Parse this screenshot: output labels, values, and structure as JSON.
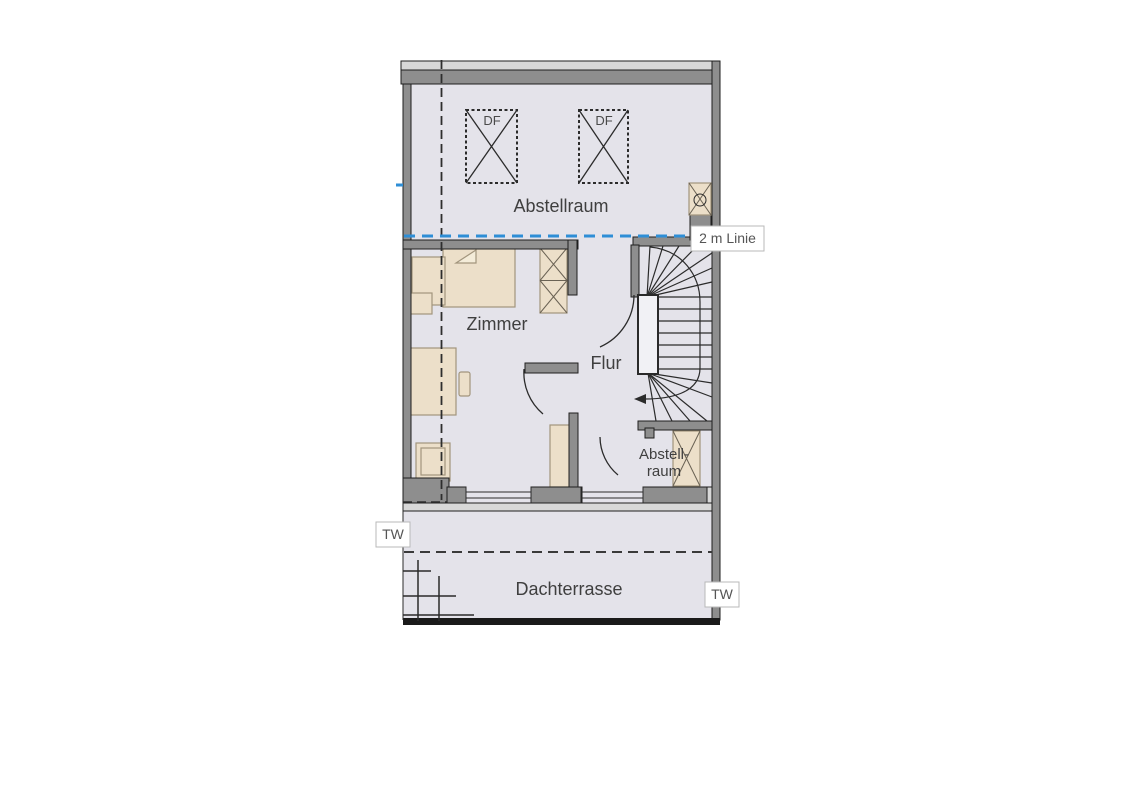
{
  "plan": {
    "rooms": {
      "abstellraum_top": "Abstellraum",
      "zimmer": "Zimmer",
      "flur": "Flur",
      "abstellraum_small_line1": "Abstell-",
      "abstellraum_small_line2": "raum",
      "dachterrasse": "Dachterrasse"
    },
    "markers": {
      "df_1": "DF",
      "df_2": "DF",
      "two_m_linie": "2 m Linie",
      "tw_left": "TW",
      "tw_right": "TW"
    }
  },
  "colors": {
    "floor": "#e4e3ea",
    "wall": "#8e8e8e",
    "wall_light": "#d8d8d8",
    "furniture": "#ecdfc9",
    "furniture_border": "#a2957d",
    "line_2m": "#2e8ed6",
    "label_text": "#3f3f3f",
    "outline": "#1f1f1f"
  }
}
